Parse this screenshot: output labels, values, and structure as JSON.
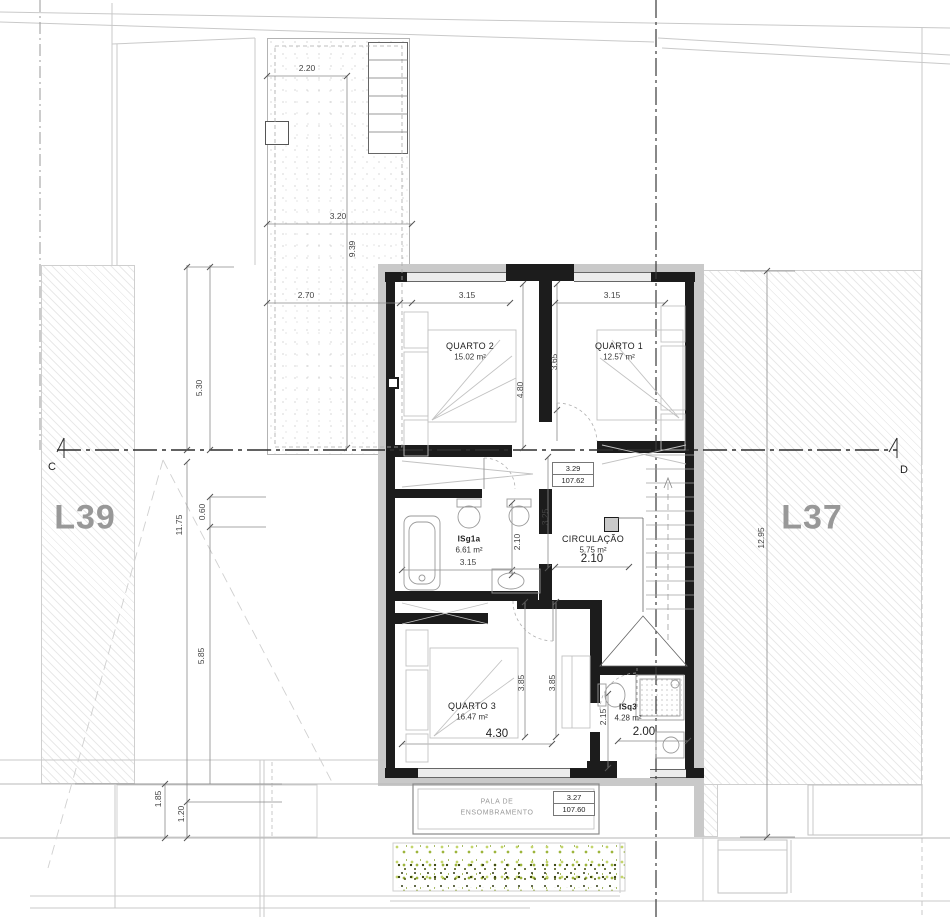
{
  "drawing": {
    "lots": {
      "left": "L39",
      "right": "L37"
    },
    "sections": {
      "left": "C",
      "right": "D"
    },
    "rooms": {
      "quarto2": {
        "name": "QUARTO 2",
        "area": "15.02 m²"
      },
      "quarto1": {
        "name": "QUARTO 1",
        "area": "12.57 m²"
      },
      "isg1a": {
        "name": "ISg1a",
        "area": "6.61 m²"
      },
      "circulacao": {
        "name": "CIRCULAÇÃO",
        "area": "5.75 m²"
      },
      "quarto3": {
        "name": "QUARTO 3",
        "area": "16.47 m²"
      },
      "isq3": {
        "name": "ISq3",
        "area": "4.28 m²"
      }
    },
    "levels": {
      "upper": {
        "rel": "3.29",
        "abs": "107.62"
      },
      "lower": {
        "rel": "3.27",
        "abs": "107.60"
      }
    },
    "canopy": {
      "line1": "PALA DE",
      "line2": "ENSOMBRAMENTO"
    },
    "dims": {
      "d220": "2.20",
      "d320": "3.20",
      "d939": "9.39",
      "d270": "2.70",
      "d530": "5.30",
      "d1175": "11.75",
      "d060": "0.60",
      "d585": "5.85",
      "d185": "1.85",
      "d120": "1.20",
      "q2_w": "3.15",
      "q1_w": "3.15",
      "q2_h": "4.80",
      "q1_h": "3.65",
      "isg_w": "3.15",
      "isg_h": "2.10",
      "hall_h": "3.25",
      "circ_w": "2.10",
      "q3_h1": "3.85",
      "q3_h2": "3.85",
      "q3_w": "4.30",
      "isq_h": "2.15",
      "isq_w": "2.00",
      "lot_right_h": "12.95"
    },
    "colors": {
      "wall": "#1c1c1c",
      "wall_band": "#c9c9c9",
      "hatch_line": "#d9d9d9",
      "veg_light": "#c3d56b",
      "veg_dark": "#3f4a15",
      "lot_label": "#989898"
    }
  }
}
